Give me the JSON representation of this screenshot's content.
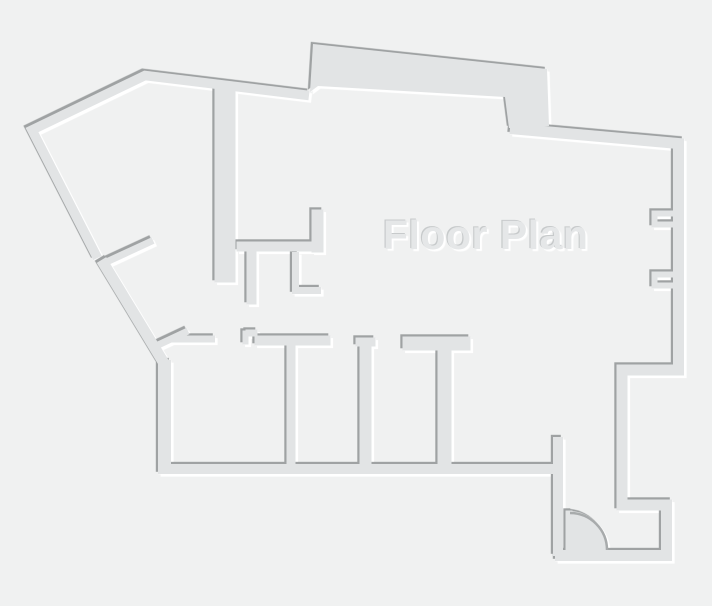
{
  "title": "Floor Plan",
  "colors": {
    "background": "#f0f1f1",
    "wall_fill": "#e2e4e5",
    "edge_dark": "#9fa2a3",
    "edge_light": "#ffffff",
    "title_color": "#e5e7e8"
  }
}
